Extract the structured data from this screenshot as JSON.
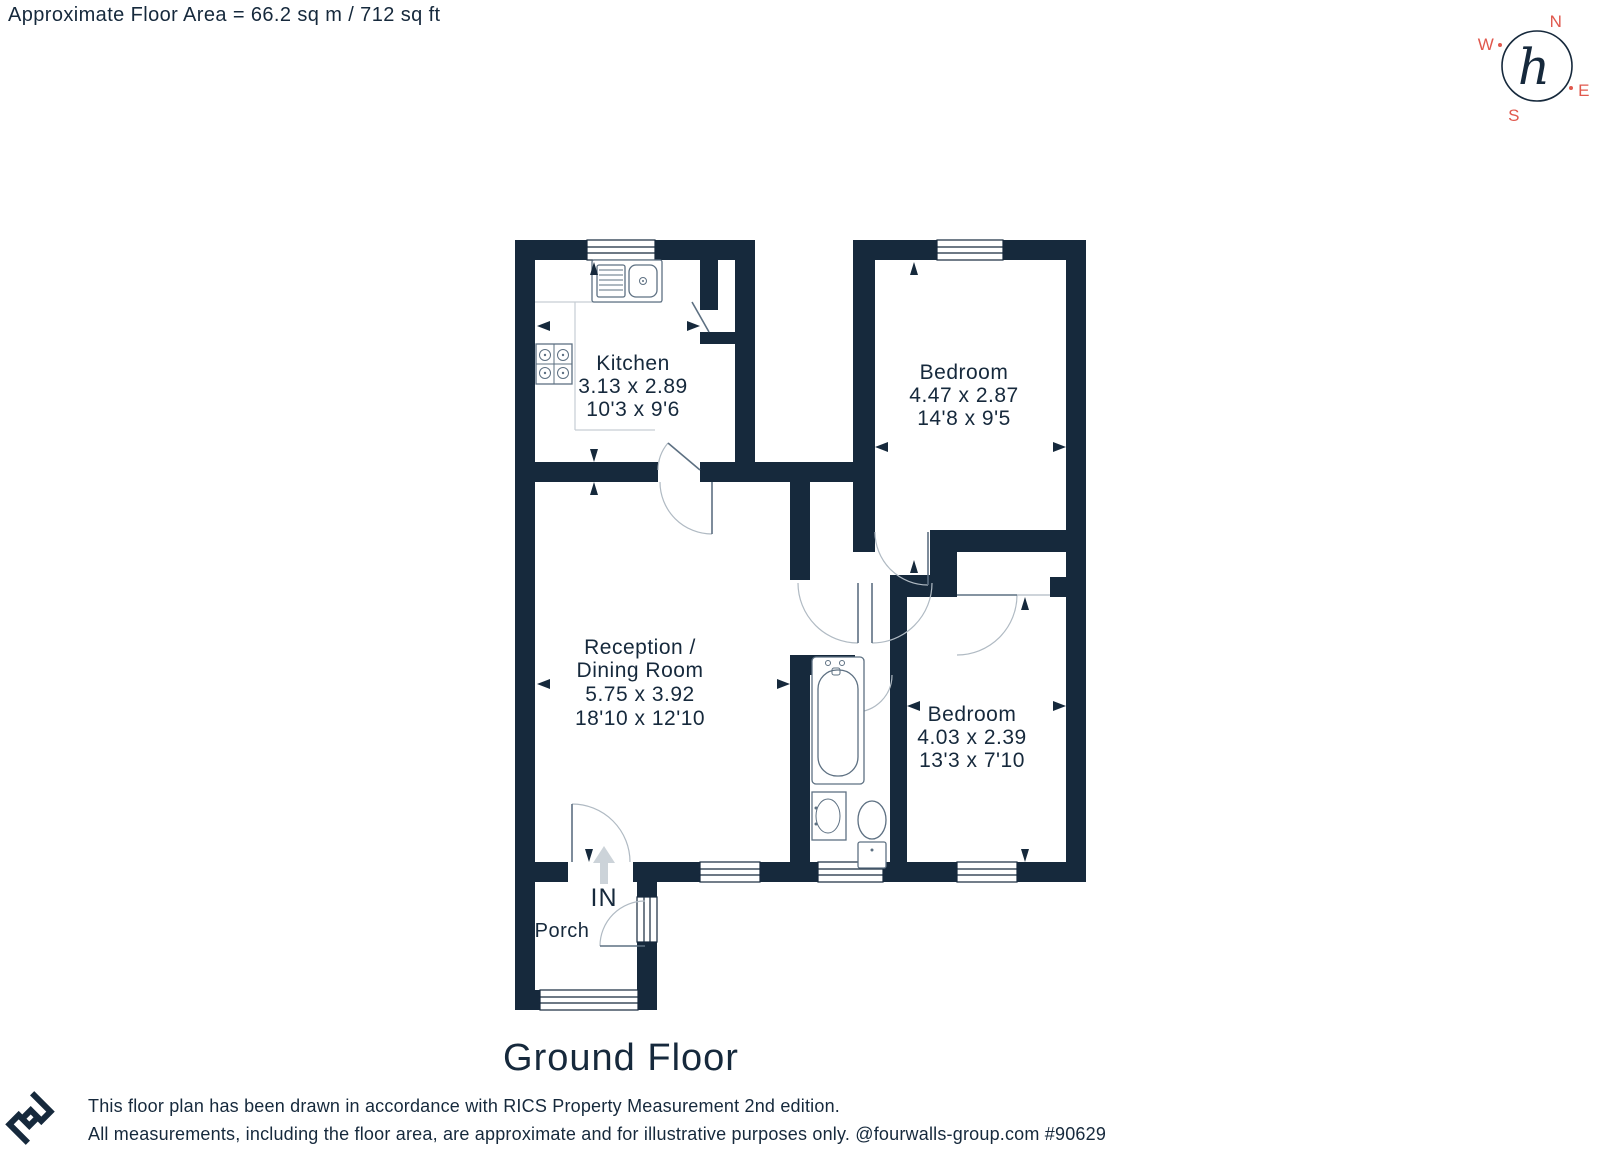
{
  "header": {
    "floor_area": "Approximate Floor Area = 66.2 sq m / 712 sq ft"
  },
  "compass": {
    "north": "N",
    "east": "E",
    "south": "S",
    "west": "W",
    "monogram": "h"
  },
  "rooms": {
    "kitchen": {
      "name": "Kitchen",
      "metric": "3.13 x 2.89",
      "imperial": "10'3 x 9'6"
    },
    "bedroom1": {
      "name": "Bedroom",
      "metric": "4.47 x 2.87",
      "imperial": "14'8 x 9'5"
    },
    "reception": {
      "name_line1": "Reception /",
      "name_line2": "Dining Room",
      "metric": "5.75 x 3.92",
      "imperial": "18'10 x 12'10"
    },
    "bedroom2": {
      "name": "Bedroom",
      "metric": "4.03 x 2.39",
      "imperial": "13'3 x 7'10"
    },
    "porch": {
      "name": "Porch"
    },
    "entrance": {
      "label": "IN"
    }
  },
  "title": "Ground Floor",
  "footer": {
    "line1": "This floor plan has been drawn in accordance with RICS Property Measurement 2nd edition.",
    "line2": "All measurements, including the floor area, are approximate and for illustrative purposes only. @fourwalls-group.com #90629"
  },
  "colors": {
    "wall": "#16293c",
    "compass_letters": "#e0584d",
    "door_arc": "#b0bac3"
  }
}
